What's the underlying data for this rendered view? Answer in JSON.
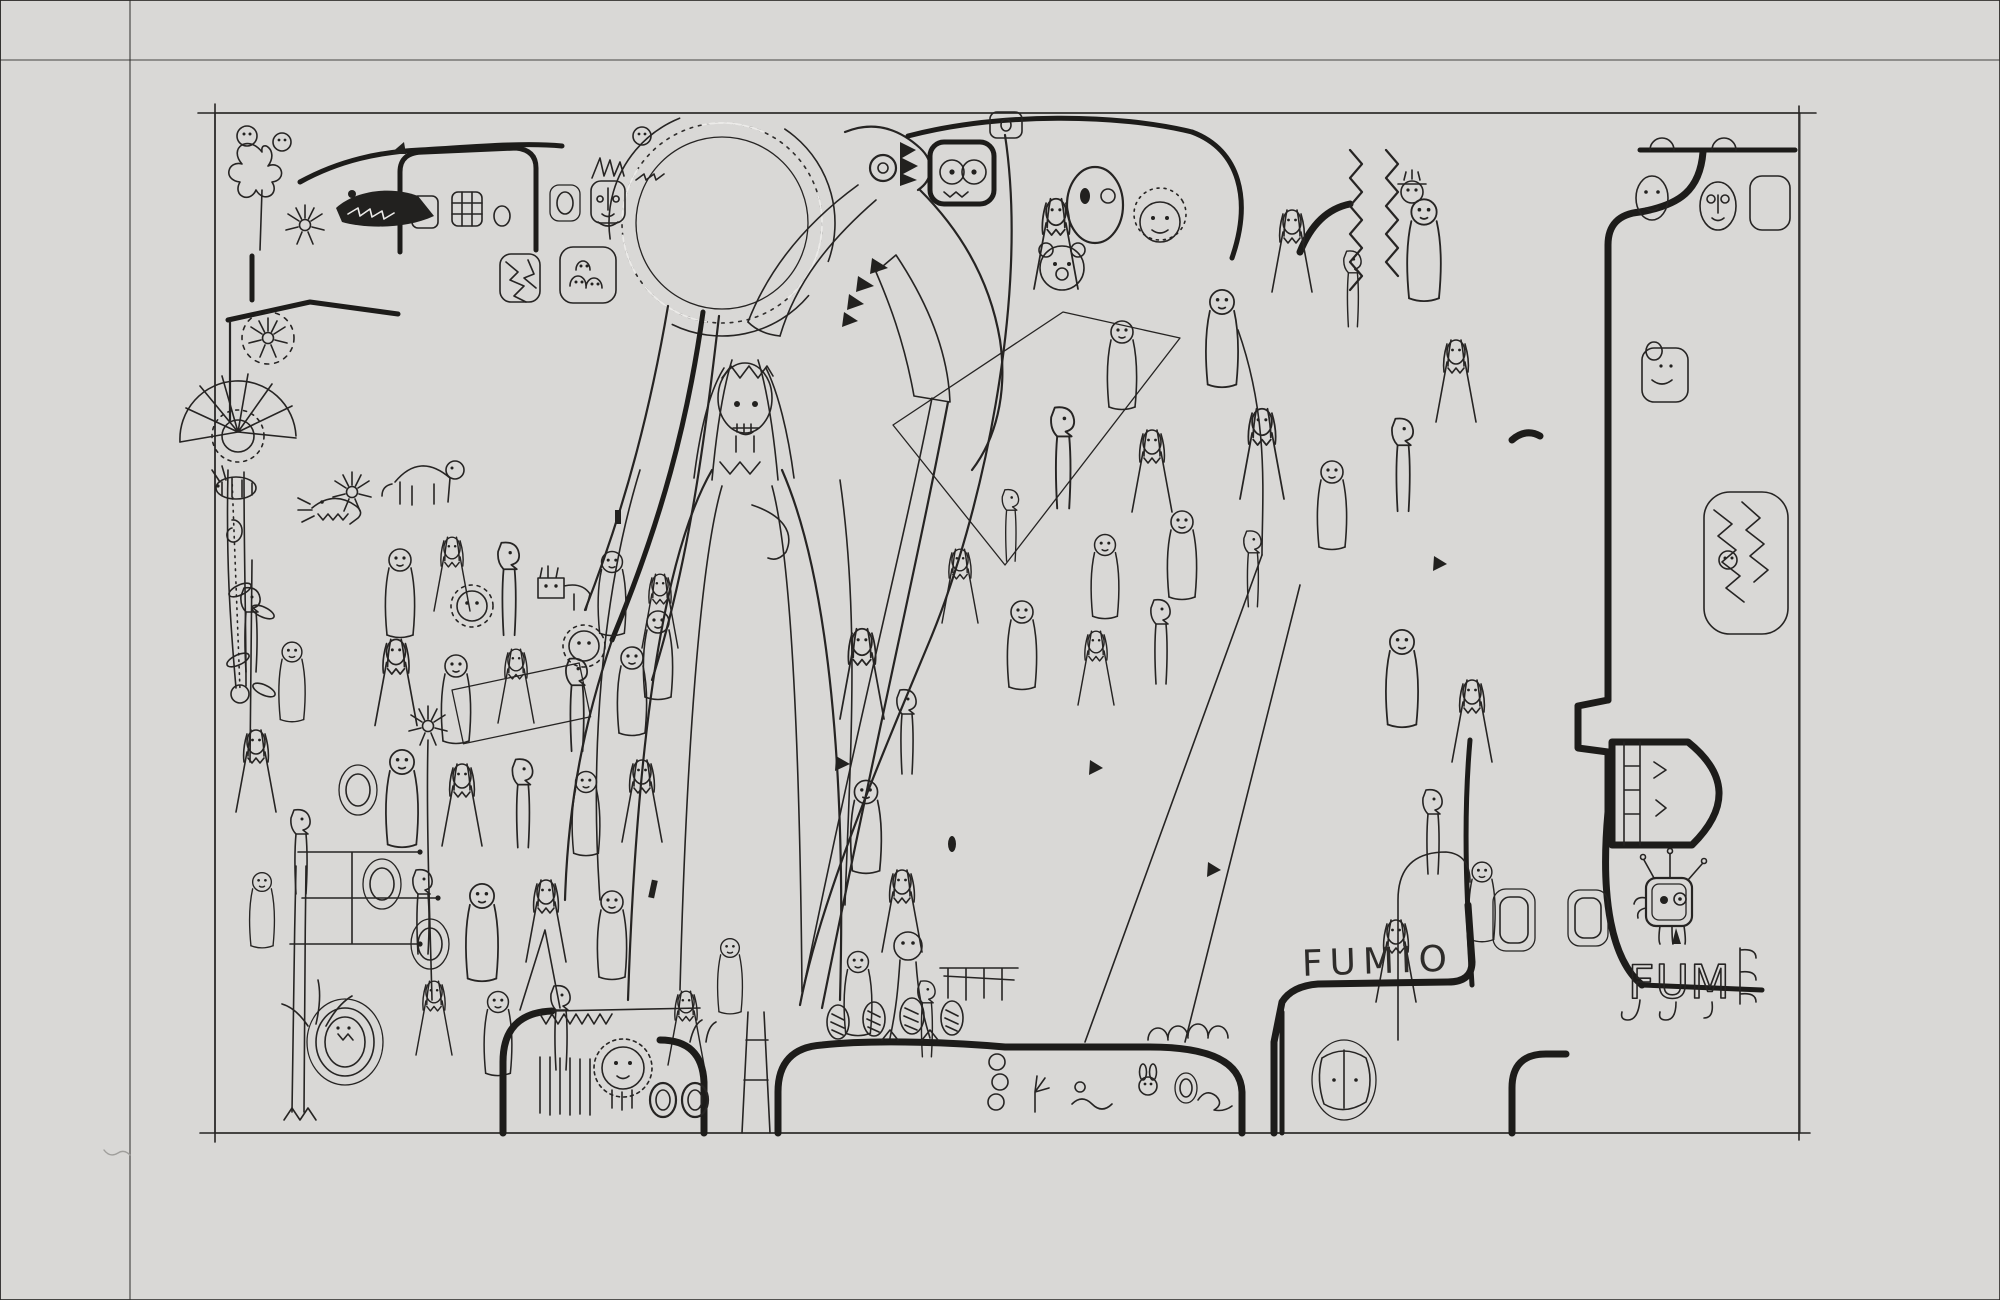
{
  "artwork": {
    "signature": "FUMIO",
    "monogram": "FUM",
    "motifs": [
      "sun-circle-with-tick-rays",
      "long-beaked-bird",
      "robed-lady-with-straight-hair",
      "crowd-of-doodle-figures",
      "flowers-and-plants-left",
      "building-with-face-windows-top-left",
      "building-with-face-windows-right",
      "crosshatch-ramp",
      "bottom-walls-with-creatures",
      "robot-on-monogram",
      "scattered-o-windows"
    ]
  },
  "palette": {
    "paper": "#e9e8e6",
    "paper_bright": "#f2f1ef",
    "paper_shadow": "#d8d7d5",
    "ink": "#262423",
    "ink_bold": "#1d1c1a",
    "pencil_border": "#a09f9c"
  },
  "figures": [
    [
      400,
      560,
      1,
      "a"
    ],
    [
      452,
      548,
      0.9,
      "b"
    ],
    [
      508,
      556,
      1.1,
      "c"
    ],
    [
      612,
      562,
      0.95,
      "a"
    ],
    [
      660,
      585,
      0.9,
      "b"
    ],
    [
      396,
      652,
      1.05,
      "b"
    ],
    [
      456,
      666,
      1,
      "a"
    ],
    [
      516,
      660,
      0.9,
      "b"
    ],
    [
      576,
      672,
      1.1,
      "c"
    ],
    [
      632,
      658,
      1,
      "a"
    ],
    [
      402,
      762,
      1.1,
      "a"
    ],
    [
      462,
      776,
      1,
      "b"
    ],
    [
      522,
      772,
      1.05,
      "c"
    ],
    [
      586,
      782,
      0.95,
      "a"
    ],
    [
      642,
      772,
      1,
      "b"
    ],
    [
      422,
      882,
      1,
      "c"
    ],
    [
      482,
      896,
      1.1,
      "a"
    ],
    [
      546,
      892,
      1,
      "b"
    ],
    [
      612,
      902,
      1,
      "a"
    ],
    [
      434,
      992,
      0.9,
      "b"
    ],
    [
      498,
      1002,
      0.95,
      "a"
    ],
    [
      560,
      998,
      1,
      "c"
    ],
    [
      250,
      600,
      1,
      "c"
    ],
    [
      292,
      652,
      0.9,
      "a"
    ],
    [
      256,
      742,
      1,
      "b"
    ],
    [
      300,
      822,
      1,
      "c"
    ],
    [
      262,
      882,
      0.85,
      "a"
    ],
    [
      658,
      622,
      1,
      "a"
    ],
    [
      862,
      642,
      1.1,
      "b"
    ],
    [
      906,
      702,
      1,
      "c"
    ],
    [
      866,
      792,
      1.05,
      "a"
    ],
    [
      902,
      882,
      1,
      "b"
    ],
    [
      858,
      962,
      0.95,
      "a"
    ],
    [
      926,
      992,
      0.9,
      "c"
    ],
    [
      686,
      1002,
      0.9,
      "b"
    ],
    [
      730,
      948,
      0.85,
      "a"
    ],
    [
      1056,
      212,
      1.1,
      "b"
    ],
    [
      1122,
      332,
      1,
      "a"
    ],
    [
      1062,
      422,
      1.2,
      "c"
    ],
    [
      1152,
      442,
      1,
      "b"
    ],
    [
      1222,
      302,
      1.1,
      "a"
    ],
    [
      1292,
      222,
      1,
      "b"
    ],
    [
      1352,
      262,
      0.9,
      "c"
    ],
    [
      1424,
      212,
      1.15,
      "a"
    ],
    [
      1262,
      422,
      1.1,
      "b"
    ],
    [
      1332,
      472,
      1,
      "a"
    ],
    [
      1402,
      432,
      1.1,
      "c"
    ],
    [
      1456,
      352,
      1,
      "b"
    ],
    [
      1182,
      522,
      1,
      "a"
    ],
    [
      1252,
      542,
      0.9,
      "c"
    ],
    [
      1402,
      642,
      1.1,
      "a"
    ],
    [
      1472,
      692,
      1,
      "b"
    ],
    [
      1432,
      802,
      1,
      "c"
    ],
    [
      1482,
      872,
      0.9,
      "a"
    ],
    [
      1396,
      932,
      1,
      "b"
    ],
    [
      1022,
      612,
      1,
      "a"
    ],
    [
      1096,
      642,
      0.9,
      "b"
    ],
    [
      1160,
      612,
      1,
      "c"
    ],
    [
      1105,
      545,
      0.95,
      "a"
    ],
    [
      960,
      560,
      0.9,
      "b"
    ],
    [
      1010,
      500,
      0.85,
      "c"
    ]
  ]
}
